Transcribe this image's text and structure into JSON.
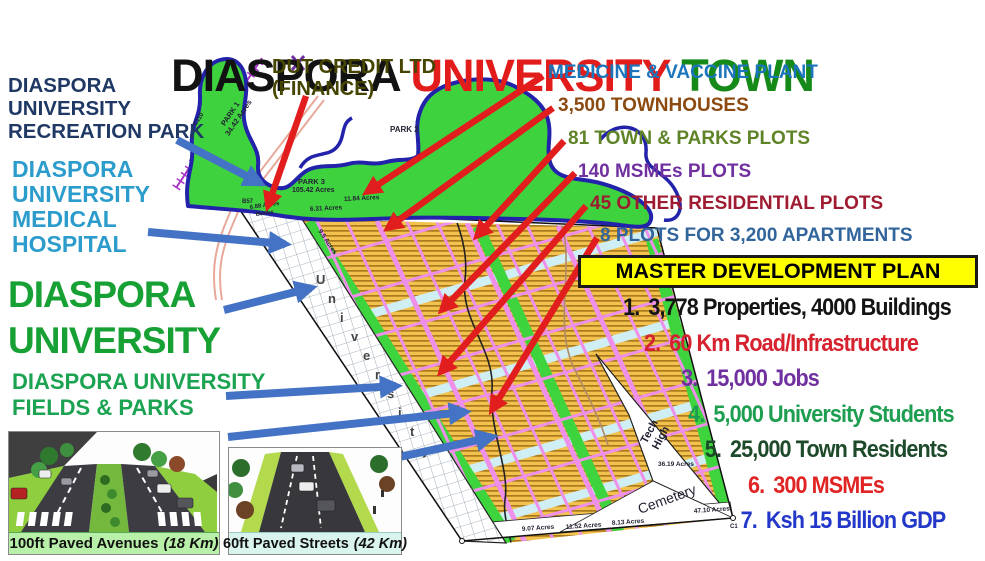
{
  "title": {
    "part1": "DIASPORA ",
    "part2": "UNIVERSITY ",
    "part3": "TOWN"
  },
  "left_labels": {
    "recreation_park": "DIASPORA\nUNIVERSITY\nRECREATION PARK",
    "medical_hospital": "DIASPORA\nUNIVERSITY\nMEDICAL\nHOSPITAL",
    "university": "DIASPORA\nUNIVERSITY",
    "fields_parks": "DIASPORA UNIVERSITY\nFIELDS & PARKS"
  },
  "finance_label": "DUT CREDIT LTD\n(FINANCE)",
  "right_labels": [
    {
      "text": "MEDICINE & VACCINE PLANT",
      "color": "#1B75BC"
    },
    {
      "text": "3,500 TOWNHOUSES",
      "color": "#8C4A10"
    },
    {
      "text": "81 TOWN & PARKS PLOTS",
      "color": "#5F8428"
    },
    {
      "text": "140 MSMEs PLOTS",
      "color": "#7030A0"
    },
    {
      "text": "45 OTHER RESIDENTIAL PLOTS",
      "color": "#9E1B32"
    },
    {
      "text": "8 PLOTS FOR 3,200 APARTMENTS",
      "color": "#31659B"
    }
  ],
  "master_plan": {
    "title": "MASTER DEVELOPMENT PLAN",
    "items": [
      {
        "num": "1.",
        "text": "3,778 Properties, 4000 Buildings",
        "color": "#141414"
      },
      {
        "num": "2.",
        "text": "60 Km Road/Infrastructure",
        "color": "#D6212E"
      },
      {
        "num": "3.",
        "text": "15,000 Jobs",
        "color": "#7030A0"
      },
      {
        "num": "4.",
        "text": "5,000 University Students",
        "color": "#1E9E50"
      },
      {
        "num": "5.",
        "text": "25,000 Town Residents",
        "color": "#1D4A2A"
      },
      {
        "num": "6.",
        "text": "300 MSMEs",
        "color": "#E02424"
      },
      {
        "num": "7.",
        "text": "Ksh 15 Billion GDP",
        "color": "#2338C8"
      }
    ]
  },
  "images": [
    {
      "caption": "100ft Paved Avenues",
      "km": "(18 Km)"
    },
    {
      "caption": "60ft Paved Streets",
      "km": "(42 Km)"
    }
  ],
  "map": {
    "park1_l1": "PARK 1",
    "park1_l2": "34.42 Acres",
    "park2": "PARK 2",
    "park3_l1": "PARK 3",
    "park3_l2": "105.42 Acres",
    "acre_1184": "11.84 Acres",
    "acre_631": "6.31 Acres",
    "acre_95": "9.5 Acres",
    "acre_688": "6.88 Acres",
    "acre_688b": "Banks",
    "b57": "B57",
    "c110": "C110",
    "c1": "C1",
    "tech_l1": "Tech",
    "tech_l2": "High",
    "cemetery": "Cemetery",
    "acre_3619": "36.19 Acres",
    "acre_4710": "47.10 Acres",
    "acre_907": "9.07 Acres",
    "acre_1152": "11.52 Acres",
    "acre_813": "8.13 Acres",
    "letters": [
      "U",
      "n",
      "i",
      "v",
      "e",
      "r",
      "s",
      "i",
      "t",
      "y"
    ],
    "colors": {
      "plot_yellow": "#F2C14E",
      "plot_stripe": "#AA7A1E",
      "road_pink": "#EE8FEA",
      "green_strip": "#3ED43E",
      "park_green": "#3FD23F",
      "river_navy": "#2222AA",
      "water_strip": "#CFEFF4",
      "arrow_red": "#E21D1D",
      "arrow_blue": "#4472C4"
    }
  }
}
